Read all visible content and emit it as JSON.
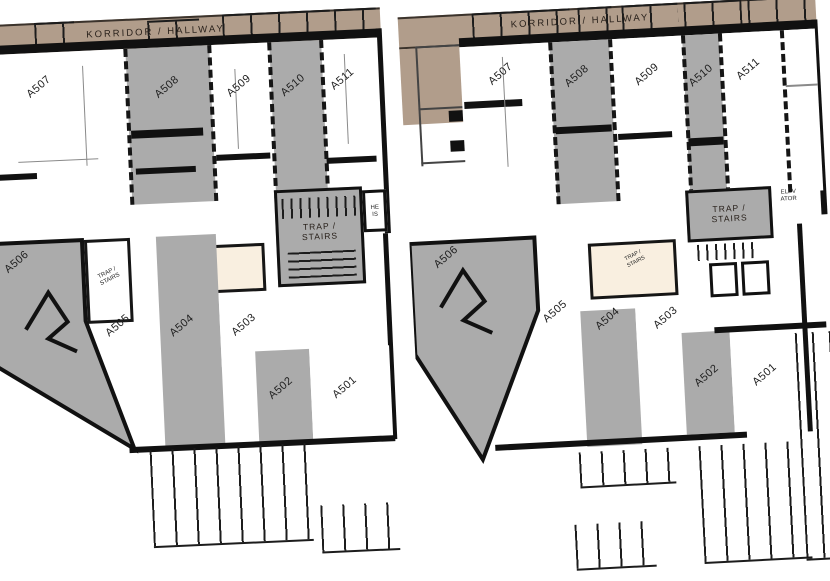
{
  "plan": {
    "corridor_label": "KORRIDOR / HALLWAY",
    "stairs_line1": "TRAP /",
    "stairs_line2": "STAIRS",
    "elevator_left_line1": "HE",
    "elevator_left_line2": "IS",
    "elevator_right_line1": "ELEV",
    "elevator_right_line2": "ATOR",
    "room_labels": {
      "a501": "A501",
      "a502": "A502",
      "a503": "A503",
      "a504": "A504",
      "a505": "A505",
      "a506": "A506",
      "a507": "A507",
      "a508": "A508",
      "a509": "A509",
      "a510": "A510",
      "a511": "A511"
    },
    "colors": {
      "room_gray": "#ababab",
      "corridor_tan": "#b19d8b",
      "room_cream": "#f9efe0",
      "wall_black": "#111111"
    }
  }
}
